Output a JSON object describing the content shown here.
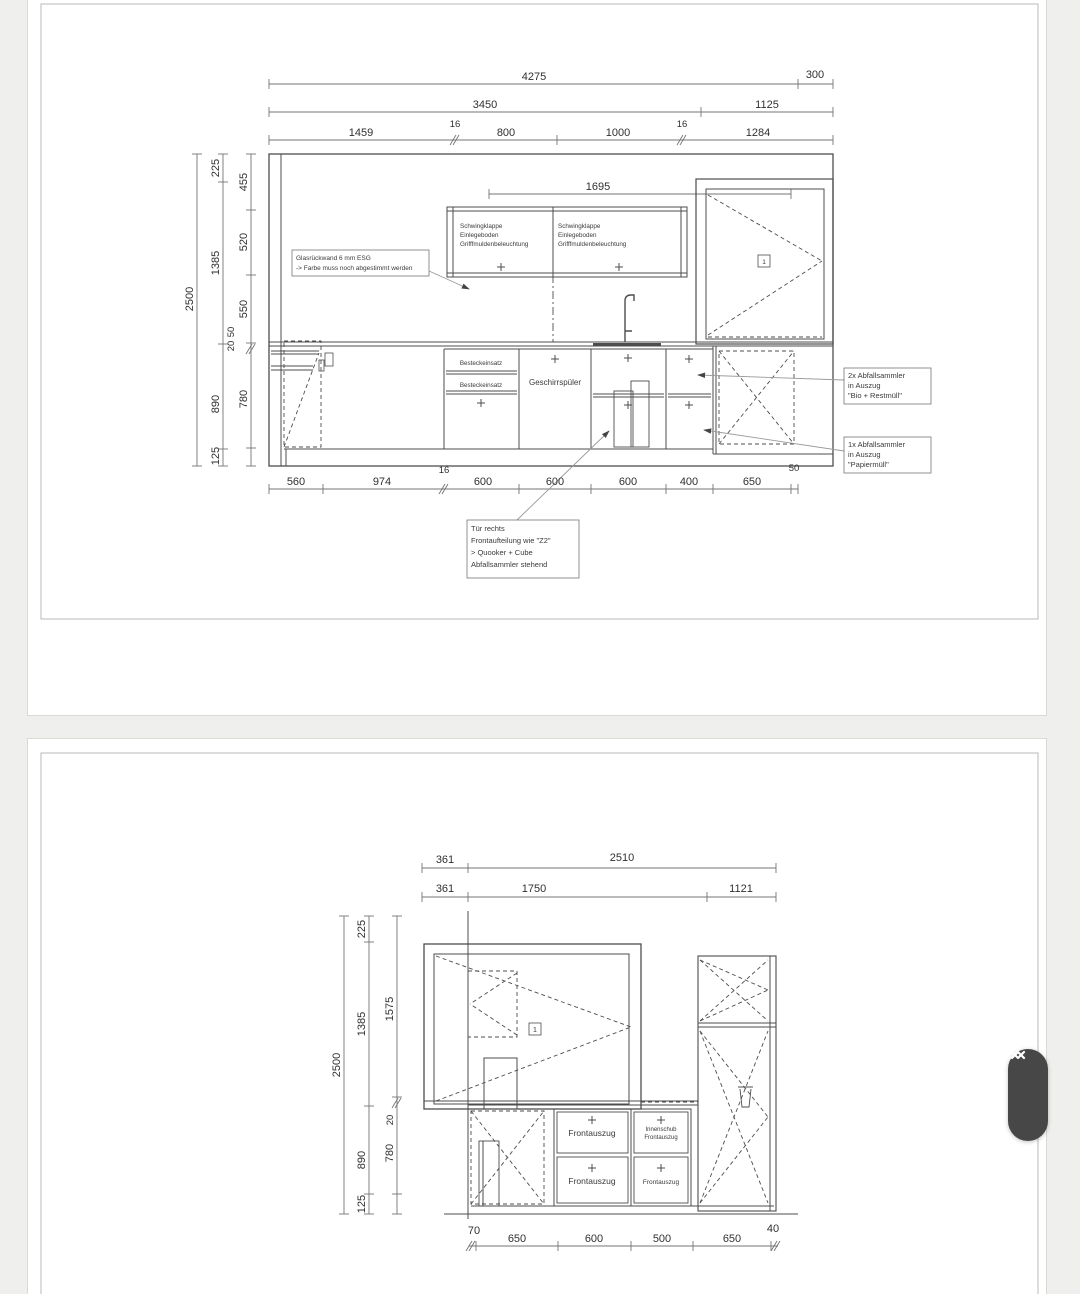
{
  "viewer": {
    "bg_color": "#efefed",
    "page_color": "#ffffff",
    "scroll_pill_color": "#474747",
    "line_color": "#4d4d4d"
  },
  "scrollbar": {
    "up_icon": "chevron-up",
    "down_icon": "chevron-down"
  },
  "page1": {
    "top": {
      "row1": [
        "4275",
        "300"
      ],
      "row2": [
        "3450",
        "1125"
      ],
      "row3": [
        "1459",
        "16",
        "800",
        "1000",
        "16",
        "1284"
      ],
      "wall_run": "1695"
    },
    "left": {
      "total": "2500",
      "mid": [
        "225",
        "1385",
        "890",
        "125"
      ],
      "inner": [
        "455",
        "520",
        "550",
        "50",
        "20",
        "780"
      ]
    },
    "bottom": [
      "560",
      "974",
      "16",
      "600",
      "600",
      "600",
      "400",
      "650",
      "50"
    ],
    "cabinets": {
      "wall_left": [
        "Schwingklappe",
        "Einlegeboden",
        "Grifffmuldenbeleuchtung"
      ],
      "wall_right": [
        "Schwingklappe",
        "Einlegeboden",
        "Grifffmuldenbeleuchtung"
      ],
      "besteck": [
        "Besteckeinsatz",
        "Besteckeinsatz"
      ],
      "dishwasher": "Geschirrspüler",
      "window_marker": "1"
    },
    "annotations": {
      "glass": [
        "Glasrückwand 6 mm ESG",
        "-> Farbe muss noch abgestimmt werden"
      ],
      "waste2": [
        "2x Abfallsammler",
        "in Auszug",
        "\"Bio + Restmüll\""
      ],
      "waste1": [
        "1x Abfallsammler",
        "in Auszug",
        "\"Papiermüll\""
      ],
      "door": [
        "Tür rechts",
        "Frontaufteilung wie \"Z2\"",
        "> Quooker + Cube",
        "Abfallsammler stehend"
      ]
    }
  },
  "page2": {
    "top": {
      "row1": [
        "361",
        "2510"
      ],
      "row2": [
        "361",
        "1750",
        "1121"
      ]
    },
    "left": {
      "total": "2500",
      "mid": [
        "225",
        "1385",
        "890",
        "125"
      ],
      "inner": [
        "1575",
        "20",
        "780"
      ]
    },
    "bottom": [
      "70",
      "650",
      "600",
      "500",
      "650",
      "40"
    ],
    "cabinets": {
      "drawers_left": [
        "Frontauszug",
        "Frontauszug"
      ],
      "inner_top": [
        "Innenschub",
        "Frontauszug"
      ],
      "inner_bottom": "Frontauszug",
      "window_marker": "1"
    }
  }
}
